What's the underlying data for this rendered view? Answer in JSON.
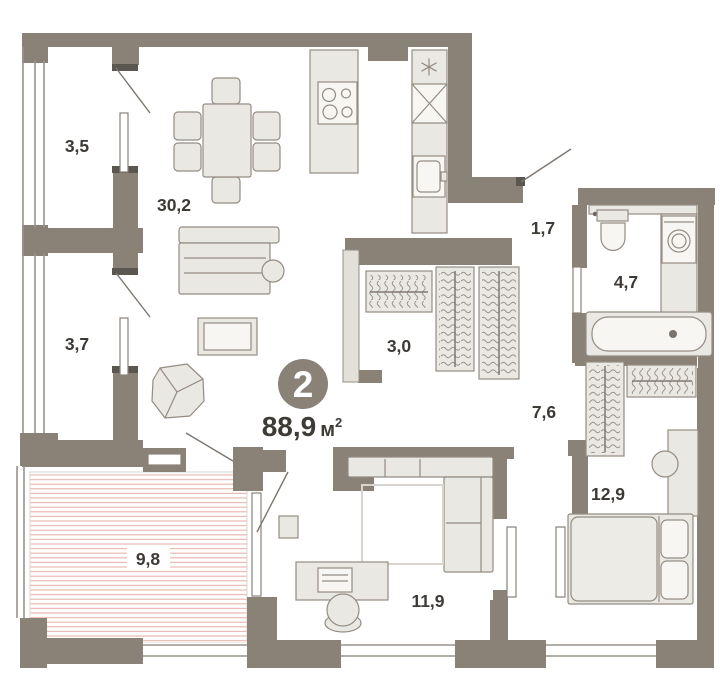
{
  "plan": {
    "title": "apartment floor plan",
    "badge": {
      "flat_number": "2",
      "area_value": "88,9",
      "area_unit": "м",
      "area_unit_sup": "2"
    },
    "rooms": [
      {
        "name": "loggia-top",
        "label": "3,5"
      },
      {
        "name": "living-kitchen",
        "label": "30,2"
      },
      {
        "name": "loggia-mid",
        "label": "3,7"
      },
      {
        "name": "entry-hall",
        "label": "1,7"
      },
      {
        "name": "bathroom",
        "label": "4,7"
      },
      {
        "name": "wardrobe",
        "label": "3,0"
      },
      {
        "name": "corridor",
        "label": "7,6"
      },
      {
        "name": "terrace",
        "label": "9,8"
      },
      {
        "name": "bedroom",
        "label": "12,9"
      },
      {
        "name": "office",
        "label": "11,9"
      }
    ],
    "colors": {
      "wall": "#8A8177",
      "furniture_fill": "#EAE8E2",
      "furniture_stroke": "#948C82",
      "terrace_hatch": "#E6B3AA",
      "label_text": "#3E3A36",
      "badge_fill": "#8A8177",
      "badge_text": "#FFFFFF",
      "background": "#FFFFFF"
    },
    "icons": [
      "stove-icon",
      "sink-icon",
      "vent-star-icon",
      "shaft-x-icon",
      "toilet-icon",
      "washing-machine-icon",
      "bathtub-icon",
      "wardrobe-hangers-icon",
      "bed-icon",
      "sofa-icon",
      "corner-sofa-icon",
      "armchair-icon",
      "dining-table-icon",
      "desk-icon",
      "office-chair-icon",
      "coffee-table-icon",
      "rug-icon",
      "stool-icon",
      "dresser-icon",
      "door-swing-icon"
    ]
  }
}
